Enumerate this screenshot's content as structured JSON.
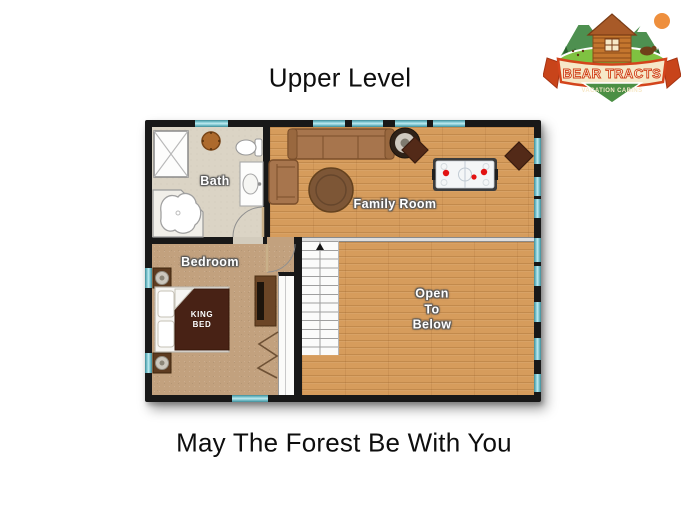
{
  "page": {
    "title": "Upper Level",
    "caption": "May The Forest Be With You"
  },
  "logo": {
    "banner_text": "BEAR TRACTS",
    "tagline": "VACATION CABINS",
    "colors": {
      "ribbon": "#f6e8c8",
      "ribbon_border": "#d3441c",
      "mountains": "#4e9050",
      "trees": "#28622c",
      "ground": "#7fc241",
      "cabin": "#c4762e",
      "sun": "#ee8f3d",
      "bear": "#6f4019"
    }
  },
  "floorplan": {
    "level": "Upper Level",
    "labels": {
      "bath": "Bath",
      "family_room": "Family Room",
      "bedroom": "Bedroom",
      "open_to_below": "Open\nTo\nBelow",
      "king_bed": "KING\nBED"
    },
    "rooms": [
      {
        "name": "Bath",
        "floor": "tile"
      },
      {
        "name": "Family Room",
        "floor": "hardwood"
      },
      {
        "name": "Bedroom",
        "floor": "carpet"
      },
      {
        "name": "Open To Below",
        "floor": "hardwood"
      },
      {
        "name": "Closet",
        "floor": "white"
      },
      {
        "name": "Staircase",
        "floor": "white",
        "direction": "up"
      }
    ],
    "furniture": [
      "sofa",
      "armchair",
      "round-ottoman",
      "round-speaker-table",
      "air-hockey-table",
      "diamond-side-table",
      "diamond-side-table",
      "king-bed",
      "nightstand-with-lamp",
      "nightstand-with-lamp",
      "dresser-with-tv",
      "bifold-closet-doors",
      "shower",
      "corner-tub",
      "toilet",
      "vanity-sink",
      "wood-stool"
    ],
    "colors": {
      "wall": "#181818",
      "window": "#7fc9d3",
      "hardwood": "#d69c5c",
      "carpet": "#c2a17e",
      "tile": "#dbd4c5",
      "bed_blanket": "#482215",
      "puck_red": "#e21212"
    }
  }
}
